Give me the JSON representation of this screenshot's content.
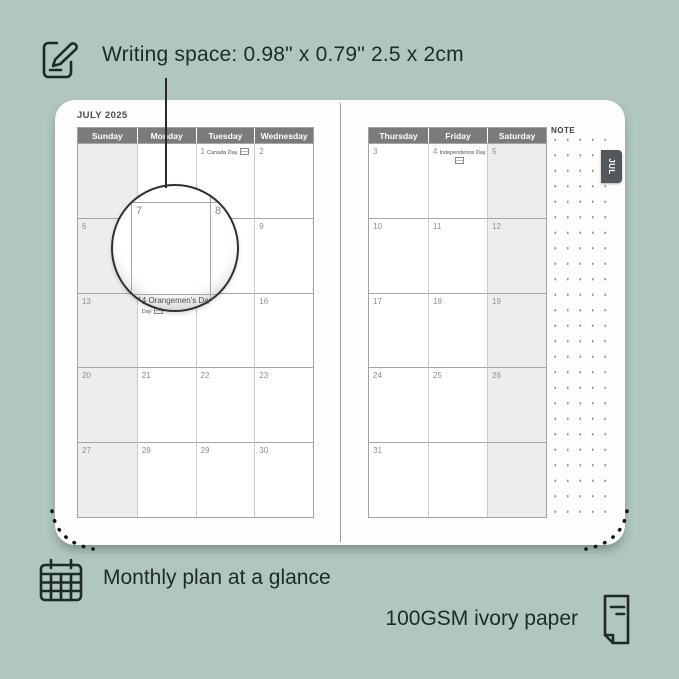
{
  "colors": {
    "background": "#b1c6be",
    "ink": "#1d2b26",
    "page": "#fdfdfd",
    "header_bg": "#7b7b7b",
    "shaded_cell": "#ededed",
    "tab_bg": "#54585a"
  },
  "annotations": {
    "writing_space": "Writing space: 0.98\" x 0.79\" 2.5 x 2cm",
    "monthly_plan": "Monthly plan at a glance",
    "paper": "100GSM ivory paper"
  },
  "planner": {
    "month_title": "JULY 2025",
    "tab_label": "JUL",
    "note_label": "NOTE",
    "left_page": {
      "headers": [
        "Sunday",
        "Monday",
        "Tuesday",
        "Wednesday"
      ],
      "shaded_col": 0,
      "rows": [
        [
          {
            "day": ""
          },
          {
            "day": ""
          },
          {
            "day": "1",
            "holiday": "Canada Day",
            "flag": "inline"
          },
          {
            "day": "2"
          }
        ],
        [
          {
            "day": "6"
          },
          {
            "day": "7"
          },
          {
            "day": "8"
          },
          {
            "day": "9"
          }
        ],
        [
          {
            "day": "13"
          },
          {
            "day": "14",
            "holiday": "Orangemen's Day",
            "flag": "inline"
          },
          {
            "day": "15"
          },
          {
            "day": "16"
          }
        ],
        [
          {
            "day": "20"
          },
          {
            "day": "21"
          },
          {
            "day": "22"
          },
          {
            "day": "23"
          }
        ],
        [
          {
            "day": "27"
          },
          {
            "day": "28"
          },
          {
            "day": "29"
          },
          {
            "day": "30"
          }
        ]
      ]
    },
    "right_page": {
      "headers": [
        "Thursday",
        "Friday",
        "Saturday"
      ],
      "shaded_col": 2,
      "rows": [
        [
          {
            "day": "3"
          },
          {
            "day": "4",
            "holiday": "Independence Day",
            "flag": "below"
          },
          {
            "day": "5"
          }
        ],
        [
          {
            "day": "10"
          },
          {
            "day": "11"
          },
          {
            "day": "12"
          }
        ],
        [
          {
            "day": "17"
          },
          {
            "day": "18"
          },
          {
            "day": "19"
          }
        ],
        [
          {
            "day": "24"
          },
          {
            "day": "25"
          },
          {
            "day": "26"
          }
        ],
        [
          {
            "day": "31"
          },
          {
            "day": ""
          },
          {
            "day": ""
          }
        ]
      ]
    },
    "magnifier": {
      "day_left": "7",
      "day_right": "8",
      "caption": "14  Orangemen's Day"
    }
  }
}
